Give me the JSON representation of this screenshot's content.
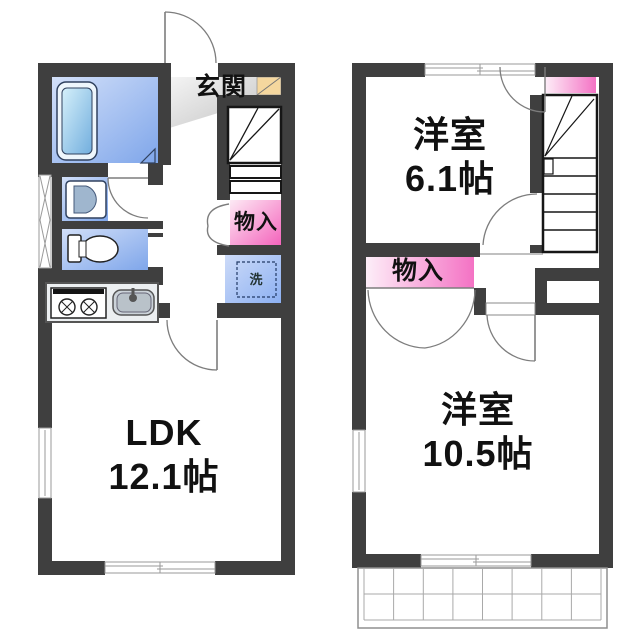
{
  "floor1": {
    "entrance_label": "玄関",
    "closet_label": "物入",
    "laundry_label": "洗",
    "living_label": "LDK",
    "living_size": "12.1帖"
  },
  "floor2": {
    "bedroom1_label": "洋室",
    "bedroom1_size": "6.1帖",
    "closet_label": "物入",
    "bedroom2_label": "洋室",
    "bedroom2_size": "10.5帖"
  },
  "colors": {
    "wall": "#3f3f3f",
    "closet_pink": "#f464bc",
    "wet_area_blue": "#7fa6ea",
    "laundry_blue": "#8cb0f2",
    "entrance_tile_tan": "#f5d79e",
    "entrance_floor_gray": "#c9c9c9"
  }
}
